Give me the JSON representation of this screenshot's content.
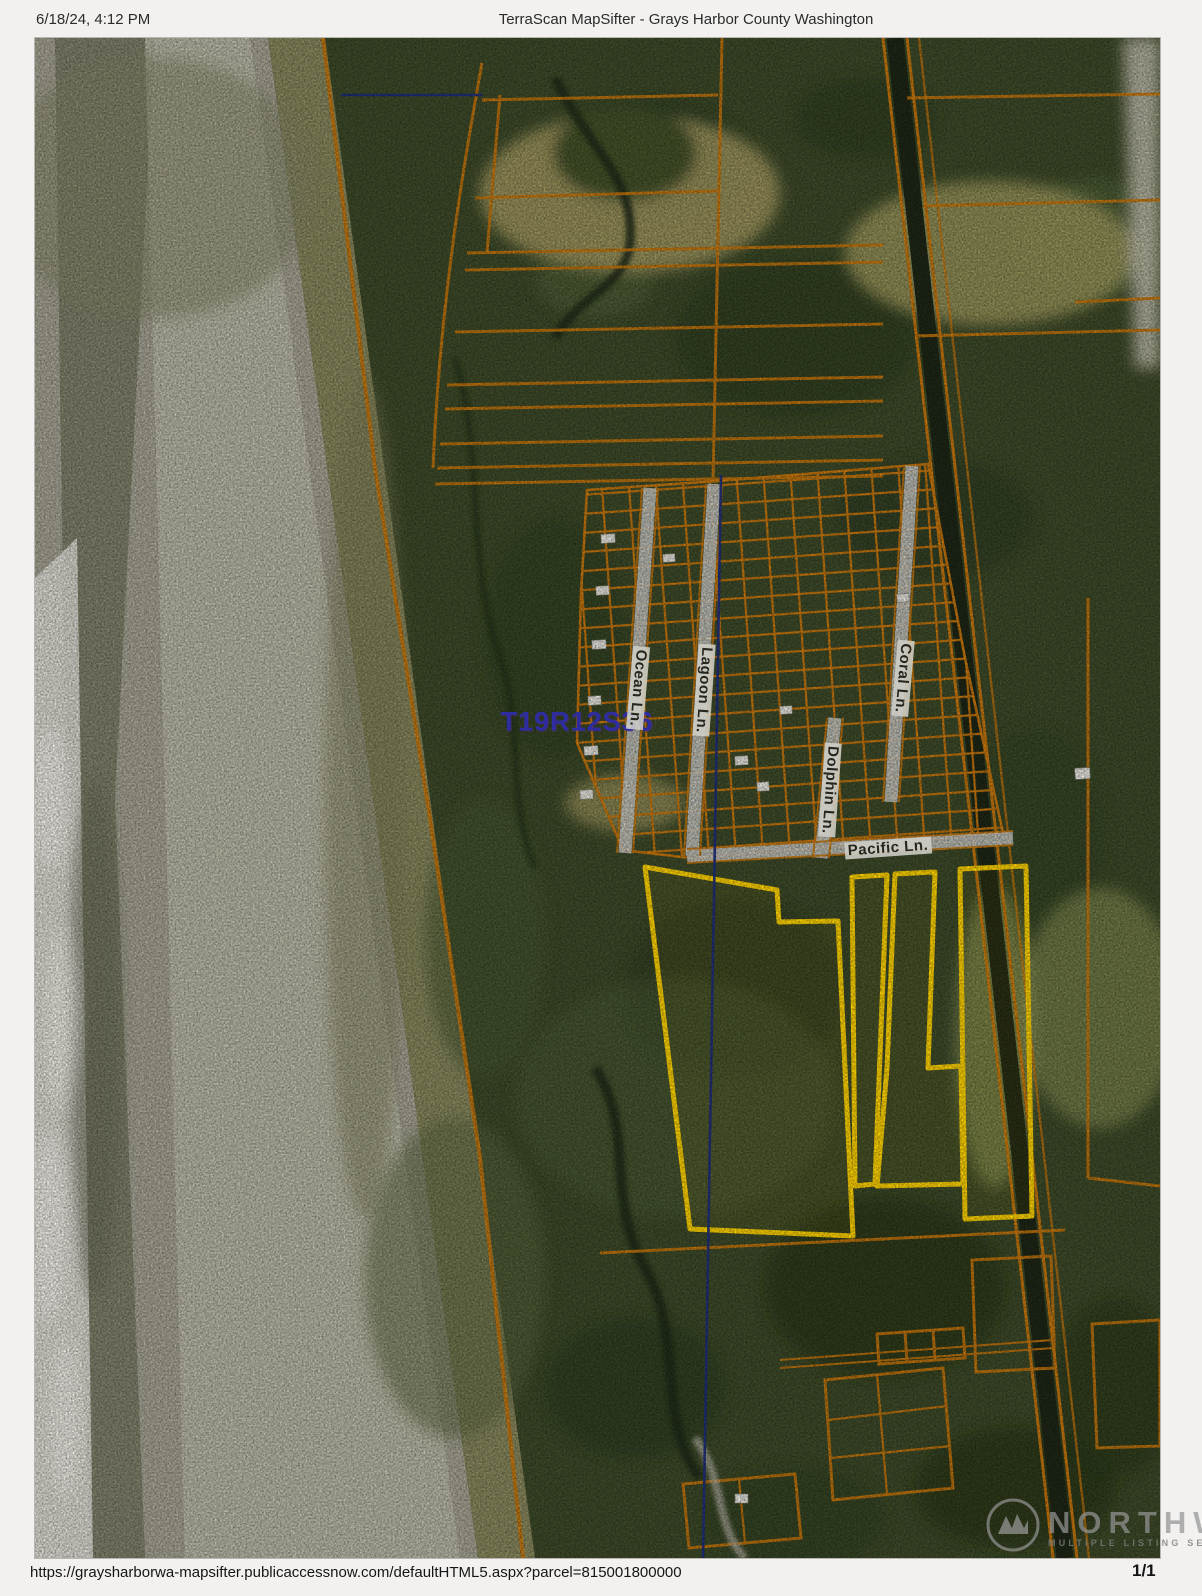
{
  "header": {
    "datetime": "6/18/24, 4:12 PM",
    "title": "TerraScan MapSifter - Grays Harbor County Washington"
  },
  "footer": {
    "url": "https://graysharborwa-mapsifter.publicaccessnow.com/defaultHTML5.aspx?parcel=815001800000",
    "page": "1/1"
  },
  "map": {
    "type": "aerial-parcel-map",
    "section_label": "T19R12S36",
    "streets": [
      {
        "label": "Ocean Ln."
      },
      {
        "label": "Lagoon Ln."
      },
      {
        "label": "Coral Ln."
      },
      {
        "label": "Dolphin Ln."
      },
      {
        "label": "Pacific Ln."
      }
    ],
    "colors": {
      "parcel_line": "#c8780e",
      "selected_parcel_line": "#ffd400",
      "section_line": "#20307f",
      "section_label": "#2d2da0",
      "road_surface": "#c6c6bf"
    }
  },
  "watermark": {
    "name": "NORTHWEST",
    "subtitle": "MULTIPLE LISTING SERVICE",
    "icon": "northwest-mls-logo"
  }
}
